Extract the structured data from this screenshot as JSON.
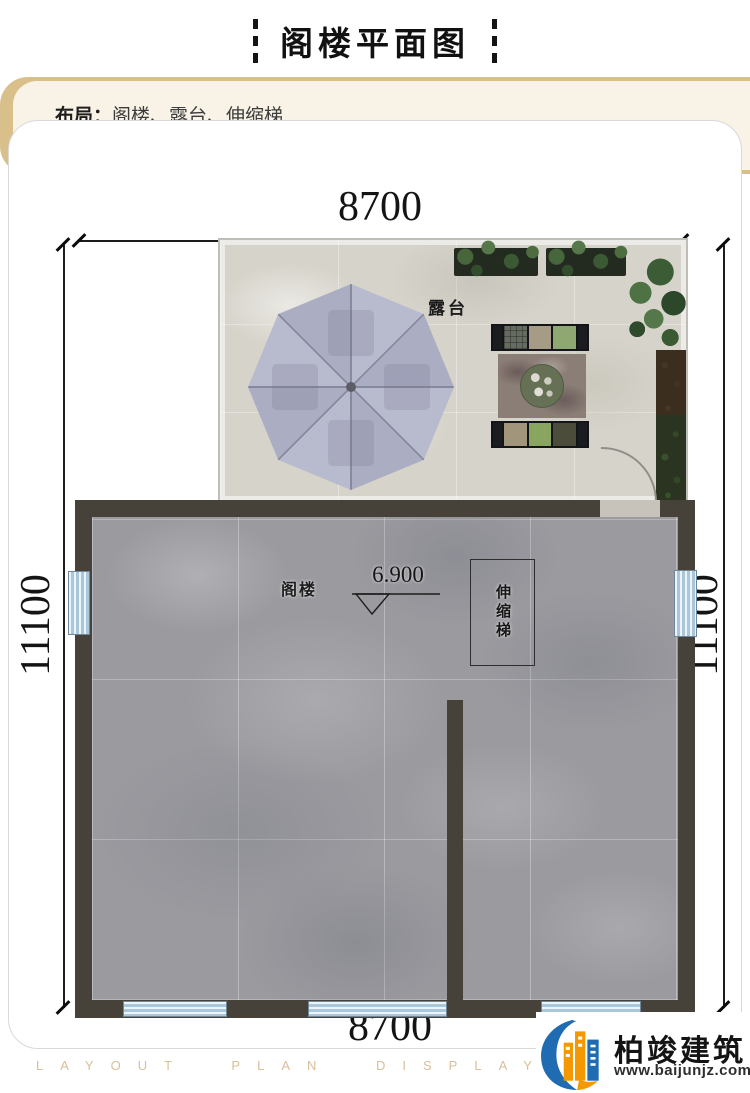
{
  "header": {
    "title": "阁楼平面图"
  },
  "info_box": {
    "layout_label": "布局：",
    "layout_value": "阁楼、露台、伸缩梯",
    "bullet": "◆",
    "area_text": "本层建筑面积:67.4m²"
  },
  "dimensions": {
    "top": "8700",
    "bottom": "8700",
    "left": "11100",
    "right": "11100"
  },
  "plan": {
    "terrace_label": "露台",
    "attic_label": "阁楼",
    "level_value": "6.900",
    "ladder_label": "伸缩梯"
  },
  "footer": {
    "watermark": "LAYOUT PLAN DISPLAY LAYOUT PLAN DISPLAY",
    "brand_name": "柏竣建筑",
    "brand_url": "www.baijunjz.com"
  },
  "colors": {
    "accent_gold": "#c28418",
    "wall": "#474239",
    "marble_floor": "#9a9a9f",
    "terrace_floor": "#d6d3ca",
    "umbrella": "#b3b5c9",
    "window_glass": "#cfe0ee"
  }
}
